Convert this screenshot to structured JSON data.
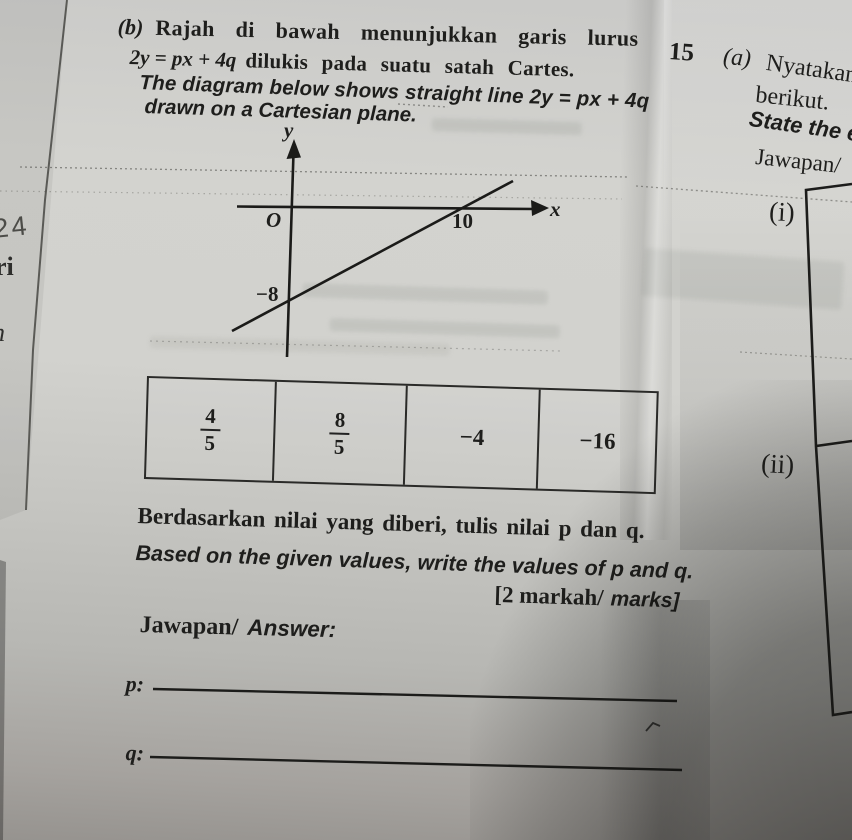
{
  "question": {
    "label": "(b)",
    "malay_line1": "Rajah di bawah menunjukkan garis lurus",
    "malay_math": "2y = px + 4q",
    "malay_line2_rest": "dilukis pada suatu satah Cartes.",
    "english_line1": "The diagram below shows straight line 2y = px + 4q",
    "english_line2": "drawn on a Cartesian plane."
  },
  "graph": {
    "y_axis_label": "y",
    "x_axis_label": "x",
    "origin_label": "O",
    "x_intercept_label": "10",
    "y_intercept_label": "−8"
  },
  "table": {
    "cell1_numerator": "4",
    "cell1_denominator": "5",
    "cell2_numerator": "8",
    "cell2_denominator": "5",
    "cell3_value": "−4",
    "cell4_value": "−16"
  },
  "instruction": {
    "malay": "Berdasarkan nilai yang diberi, tulis nilai p dan q.",
    "english": "Based on the given values, write the values of p and q.",
    "marks_malay": "[2 markah/",
    "marks_english": "marks]"
  },
  "answer_section": {
    "jawapan": "Jawapan/",
    "answer": "Answer:",
    "p_label": "p:",
    "q_label": "q:"
  },
  "right_column": {
    "question_number": "15",
    "part_label": "(a)",
    "malay_line1": "Nyatakan",
    "malay_line2": "berikut.",
    "english_fragment": "State the e",
    "jawapan": "Jawapan/",
    "item_i": "(i)",
    "item_ii": "(ii)"
  },
  "margin_notes": {
    "handwritten": "24",
    "fragment1": "ri",
    "fragment2": "n"
  },
  "colors": {
    "paper": "#cdcdc9",
    "ink": "#1e1e1c"
  }
}
